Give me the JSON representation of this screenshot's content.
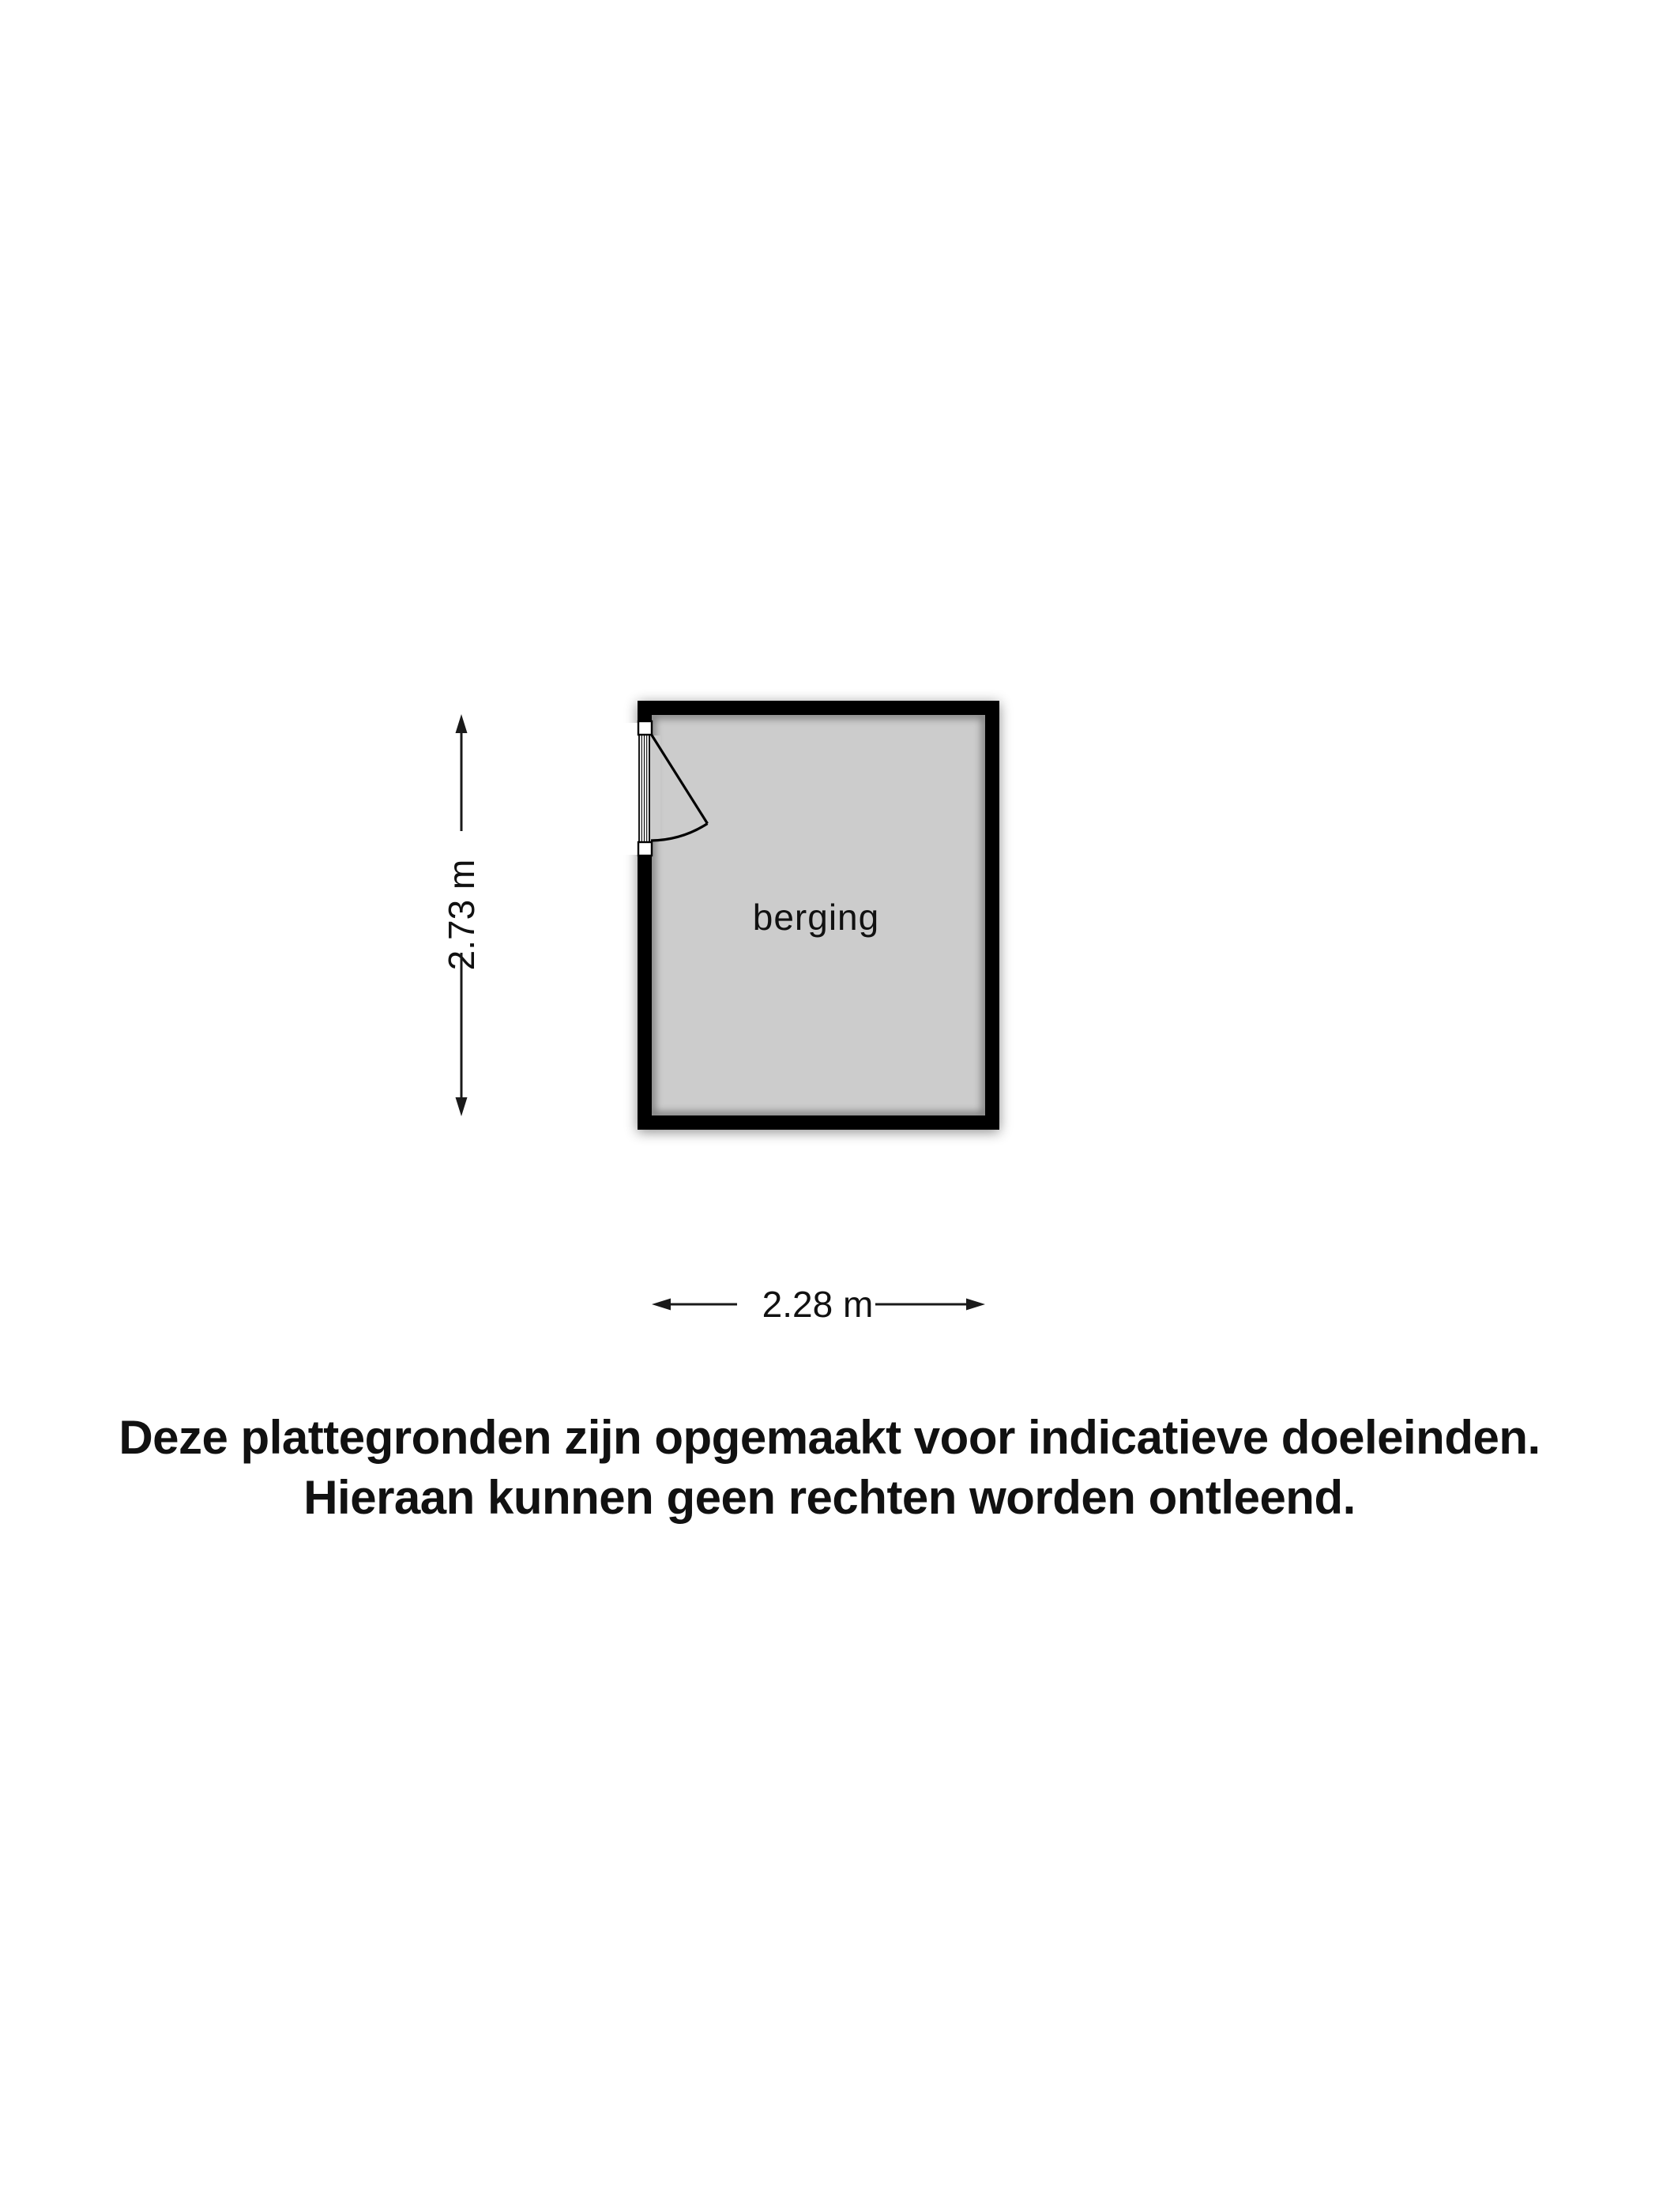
{
  "floor_plan": {
    "room": {
      "label": "berging"
    },
    "dimensions": {
      "height": {
        "label": "2.73 m"
      },
      "width": {
        "label": "2.28 m"
      }
    },
    "colors": {
      "wall": "#000000",
      "floor": "#cccccc",
      "background": "#ffffff",
      "line": "#1a1a1a",
      "text": "#111111"
    }
  },
  "disclaimer": {
    "line1": "Deze plattegronden zijn opgemaakt voor indicatieve doeleinden.",
    "line2": "Hieraan kunnen geen rechten worden ontleend."
  }
}
